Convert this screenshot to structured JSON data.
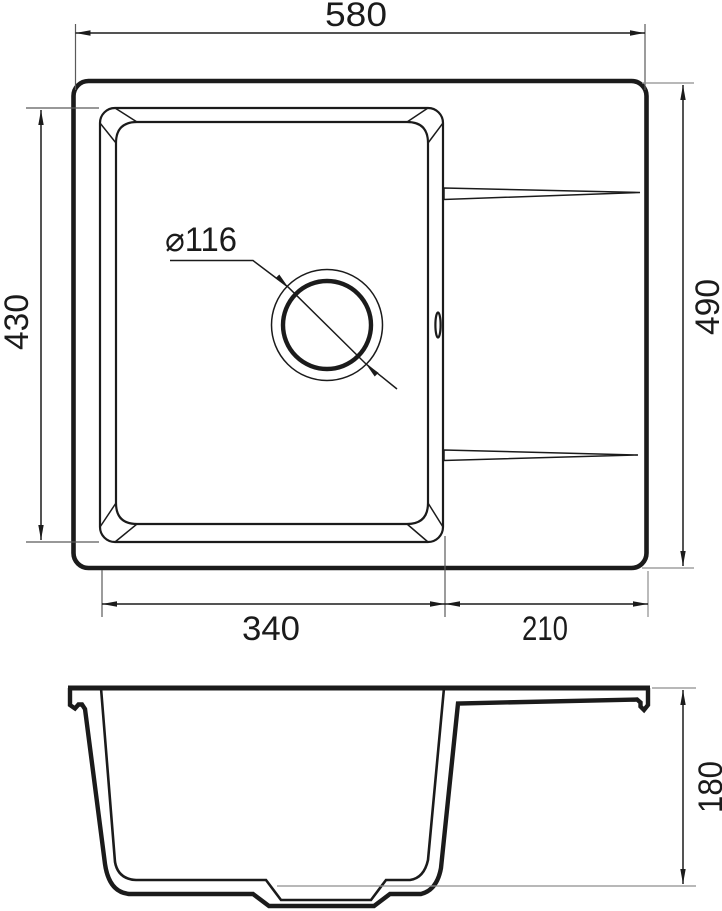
{
  "drawing": {
    "plan_view": {
      "overall_width_label": "580",
      "overall_depth_label": "490",
      "bowl_length_label": "430",
      "bowl_width_label": "340",
      "drainboard_width_label": "210",
      "drain_diameter_label": "⌀116"
    },
    "section_view": {
      "depth_label": "180"
    },
    "colors": {
      "object_line": "#1b1b1b",
      "extension_line": "#8d8d8d",
      "background": "#ffffff"
    }
  }
}
